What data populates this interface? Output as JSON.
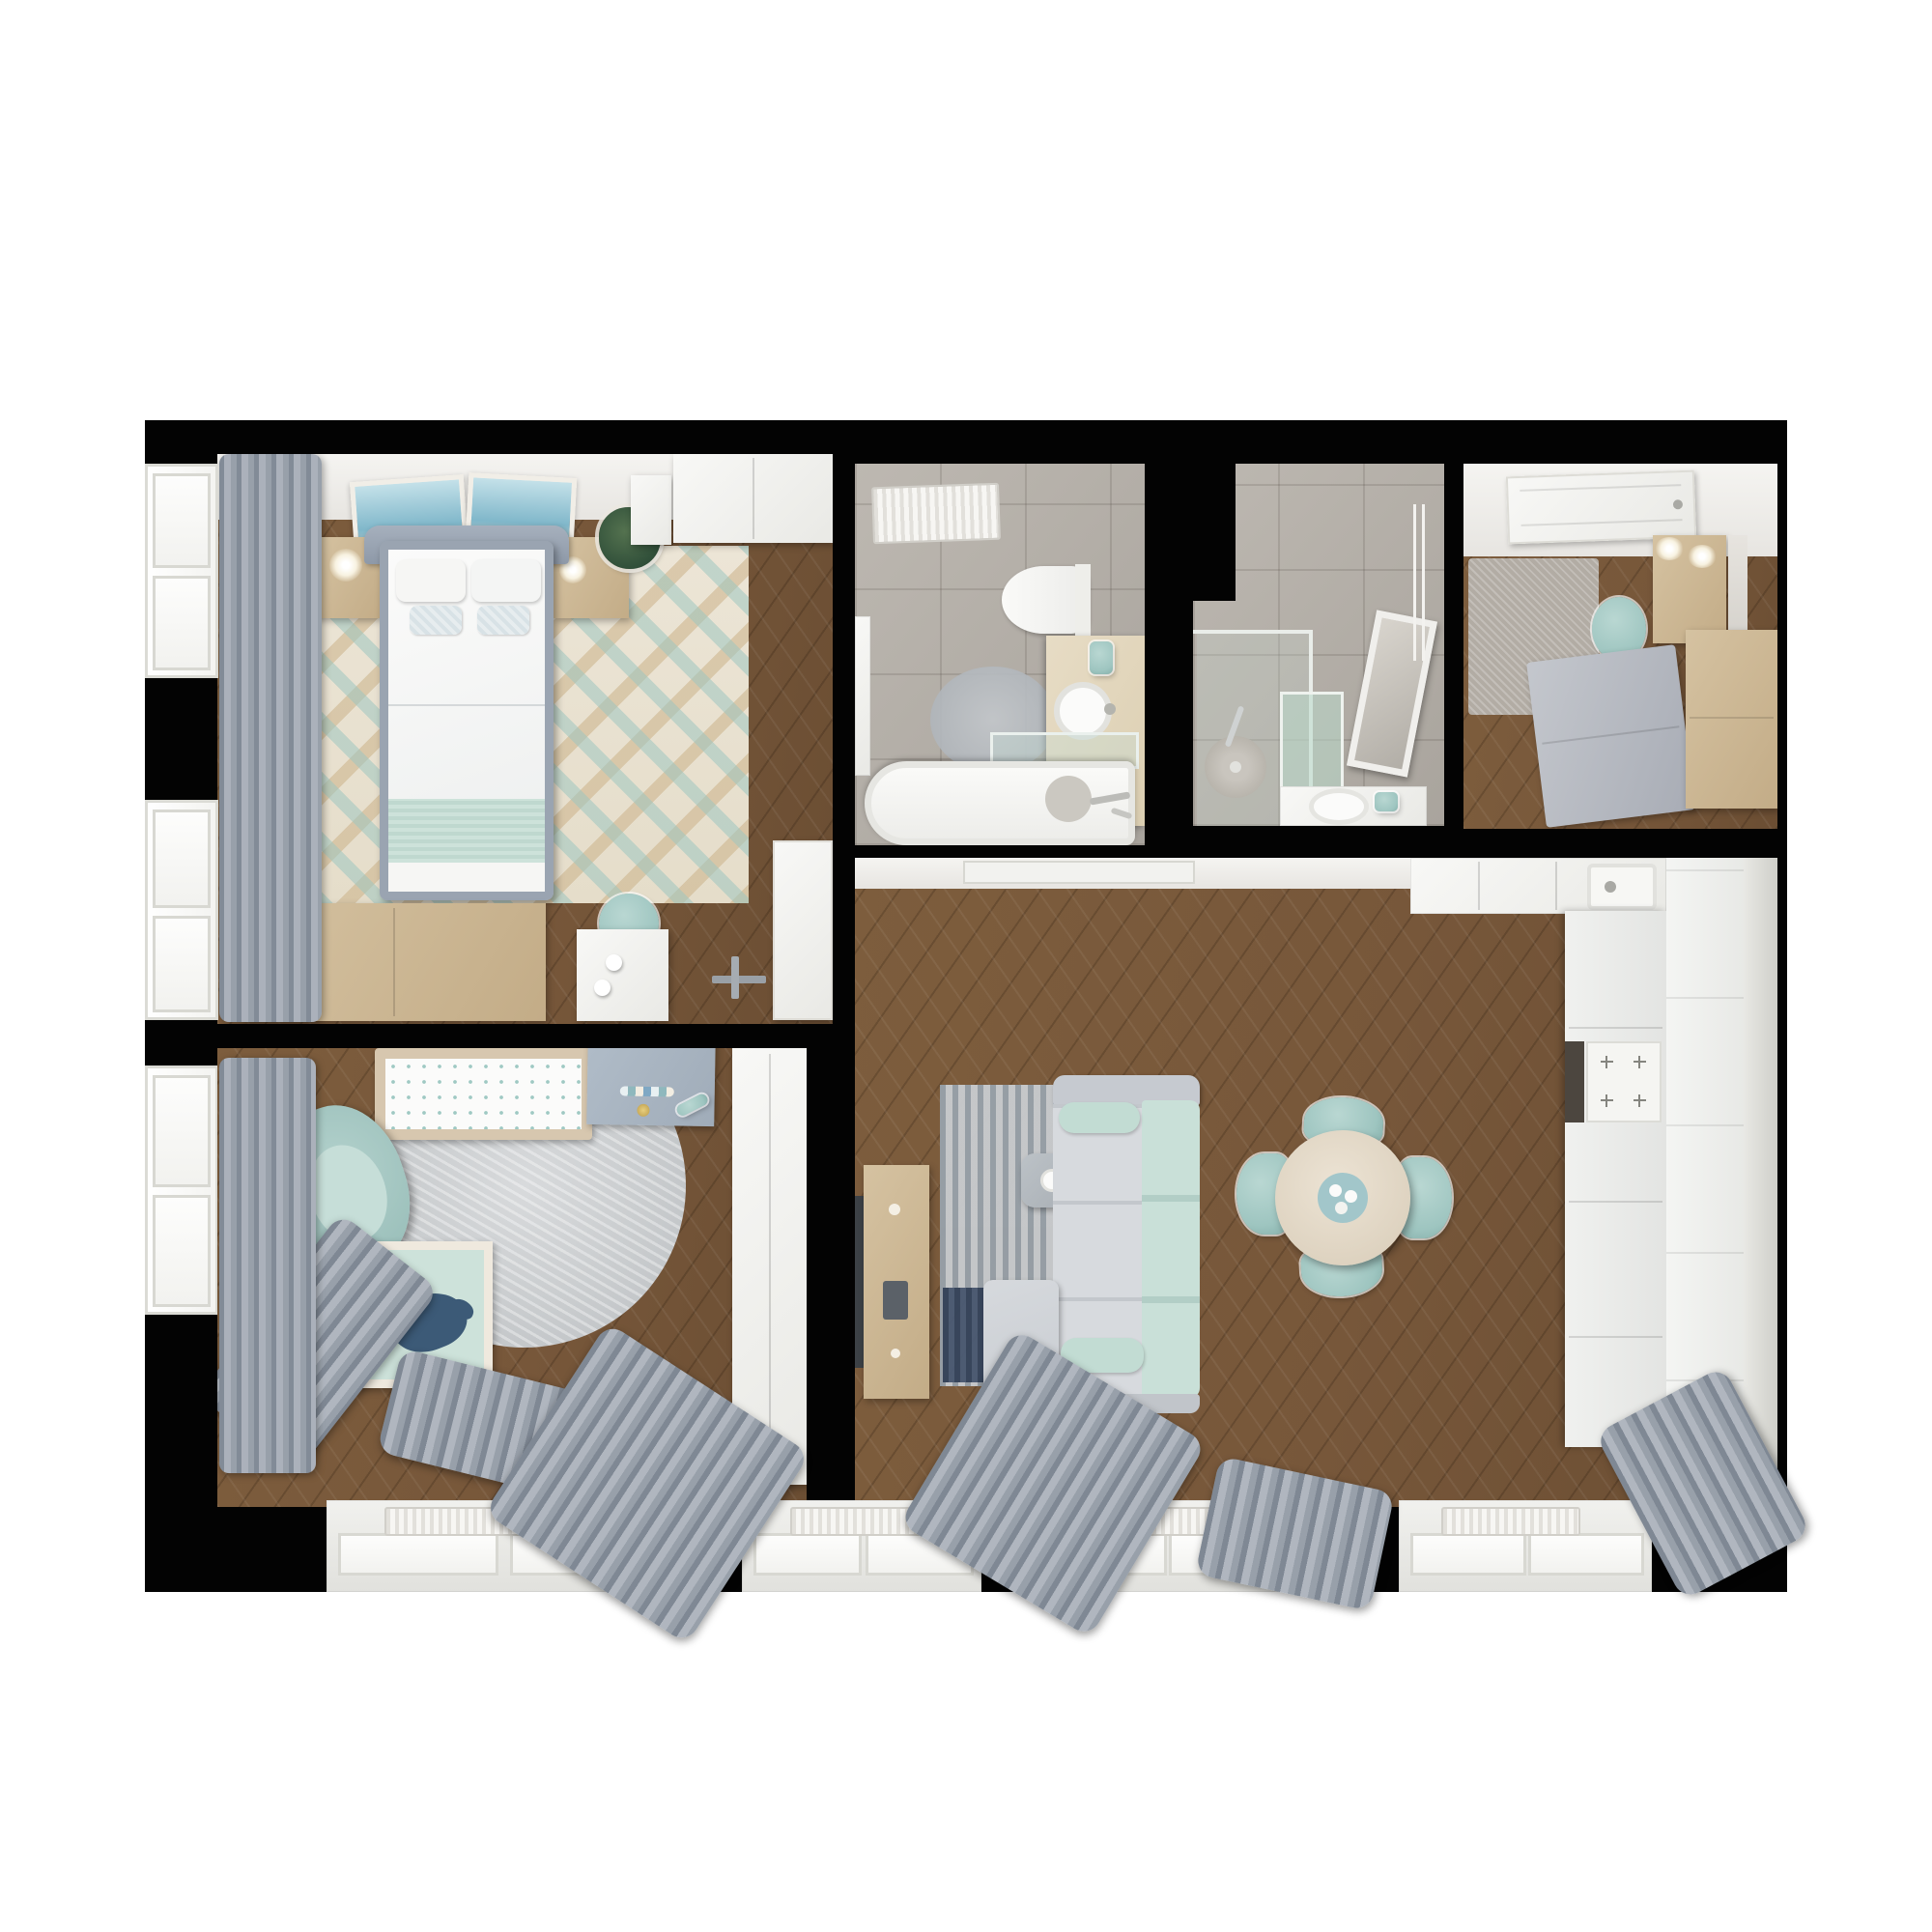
{
  "meta": {
    "description": "Top-down 3D rendered floor plan of a furnished apartment on a black background",
    "view": "top-down render",
    "visible_text": "none"
  },
  "palette": {
    "wood": "#7d5d3d",
    "wood_dark": "#6b4e33",
    "tile": "#a9a49d",
    "teal": "#9ec5c0",
    "mint": "#cde2da",
    "sofa": "#ced2d6",
    "curtain": "#98a0aa",
    "navy": "#36455c",
    "wood_furniture": "#d5c2a1",
    "counter": "#f0f1ef",
    "vanity": "#e7dcc5",
    "desk_blue": "#b0bcc8",
    "rug_cream": "#ece5d6",
    "rug_gray": "#c9ccce",
    "background": "#030303",
    "page": "#ffffff"
  },
  "rooms": [
    {
      "id": "bedroom",
      "label": "Bedroom"
    },
    {
      "id": "bathroom",
      "label": "Bathroom"
    },
    {
      "id": "shower-room",
      "label": "Shower room"
    },
    {
      "id": "hallway",
      "label": "Entry hallway"
    },
    {
      "id": "living-room",
      "label": "Living room"
    },
    {
      "id": "kitchen",
      "label": "Kitchen"
    },
    {
      "id": "kids-room",
      "label": "Kids room"
    }
  ],
  "furniture": {
    "bedroom": [
      "double-bed",
      "headboard",
      "pillows",
      "mint-throw-blanket",
      "left-nightstand",
      "right-nightstand",
      "table-lamps",
      "potted-plant",
      "two-wall-art-frames",
      "chevron-rug",
      "low-dresser",
      "white-desk",
      "teal-stool",
      "door",
      "closet",
      "window-curtains"
    ],
    "bathroom": [
      "bathtub",
      "glass-screen",
      "vanity-counter",
      "round-vessel-sink",
      "toilet",
      "towel-radiator",
      "round-rug",
      "teal-towel"
    ],
    "shower_room": [
      "walk-in-shower",
      "glass-partition",
      "rain-shower-head",
      "tilted-mirror",
      "sink",
      "teal-towel",
      "towel-rail"
    ],
    "hallway": [
      "entry-door",
      "runner-rug",
      "teal-pouf",
      "wood-wardrobe",
      "wall-lamps",
      "mirror",
      "gray-sideboard",
      "wood-cabinet"
    ],
    "living_room": [
      "corner-sofa",
      "chaise",
      "mint-back-cushions",
      "striped-rug",
      "navy-rug-corner",
      "side-table-with-cup",
      "tv",
      "tv-console",
      "round-dining-table",
      "four-teal-chairs",
      "ceiling-vent"
    ],
    "kitchen": [
      "l-shaped-counter",
      "sink-with-faucet",
      "cooktop",
      "oven",
      "tall-cabinets"
    ],
    "kids_room": [
      "crib-with-dotted-mattress",
      "blue-changing-desk",
      "round-gray-rug",
      "teal-armchair",
      "mint-playpen",
      "navy-whale-plush",
      "white-wardrobe",
      "window-curtains",
      "radiator"
    ]
  }
}
